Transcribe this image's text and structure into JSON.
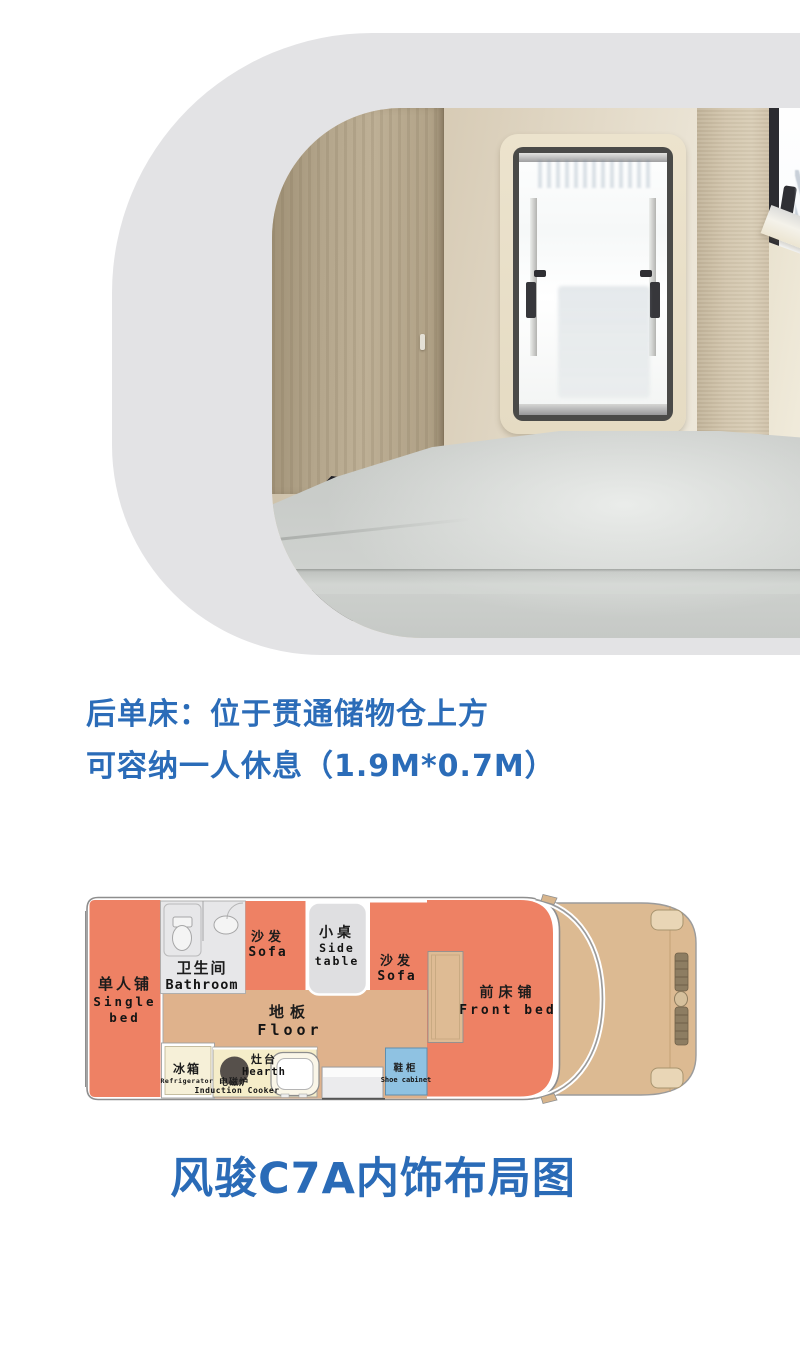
{
  "caption": {
    "line1": "后单床：位于贯通储物仓上方",
    "line2": "可容纳一人休息（1.9M*0.7M）",
    "color": "#2b6cb8"
  },
  "title": {
    "text": "风骏C7A内饰布局图",
    "color": "#2a6bb7"
  },
  "floorplan": {
    "zones": {
      "single_bed": {
        "zh": "单人铺",
        "en1": "Single",
        "en2": "bed"
      },
      "bathroom": {
        "zh": "卫生间",
        "en": "Bathroom"
      },
      "sofa_left": {
        "zh": "沙发",
        "en": "Sofa"
      },
      "side_table": {
        "zh": "小桌",
        "en1": "Side",
        "en2": "table"
      },
      "sofa_right": {
        "zh": "沙发",
        "en": "Sofa"
      },
      "floor": {
        "zh": "地板",
        "en": "Floor"
      },
      "refrigerator": {
        "zh": "冰箱",
        "en": "Refrigerator"
      },
      "induction_cooker": {
        "zh": "电磁炉",
        "en": "Induction Cooker"
      },
      "hearth": {
        "zh": "灶台",
        "en": "Hearth"
      },
      "shoe_cabinet": {
        "zh": "鞋柜",
        "en": "Shoe cabinet"
      },
      "front_bed": {
        "zh": "前床铺",
        "en": "Front bed"
      }
    },
    "colors": {
      "bed_sofa": "#ee8164",
      "floor": "#dfb28c",
      "cab": "#dcba92",
      "kitchen_counter": "#f5edc9",
      "refrigerator": "#f6f0d8",
      "shoe_cabinet": "#8fc2e2",
      "gray_block": "#e6e6e9",
      "outline": "#8e8e8e",
      "photo_frame": "#e3e3e5"
    }
  }
}
